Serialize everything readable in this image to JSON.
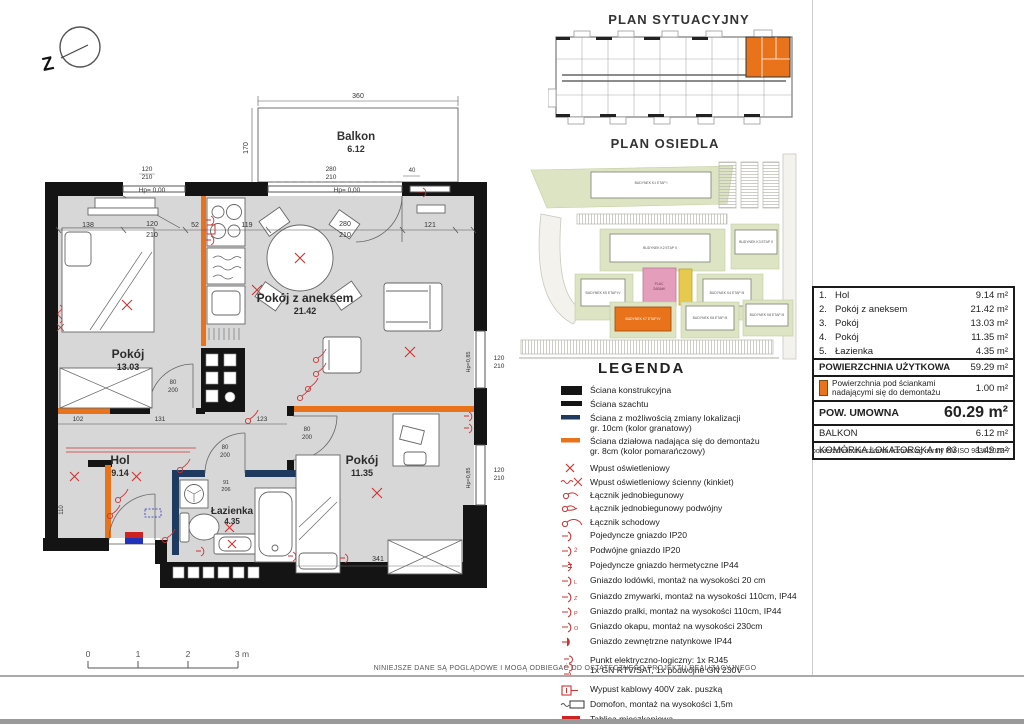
{
  "north_letter": "Z",
  "titles": {
    "situational": "PLAN SYTUACYJNY",
    "estate": "PLAN OSIEDLA",
    "legend": "LEGENDA"
  },
  "plan": {
    "balcony": {
      "name": "Balkon",
      "area": "6.12"
    },
    "rooms": {
      "pokoj1": {
        "name": "Pokój",
        "area": "13.03"
      },
      "aneks": {
        "name": "Pokój z aneksem",
        "area": "21.42"
      },
      "hol": {
        "name": "Hol",
        "area": "9.14"
      },
      "lazienka": {
        "name": "Łazienka",
        "area": "4.35"
      },
      "pokoj2": {
        "name": "Pokój",
        "area": "11.35"
      }
    },
    "dims": {
      "c1": "138",
      "c2": "120",
      "c3": "210",
      "c4": "52",
      "c5": "119",
      "c6": "280",
      "c7": "210",
      "c8": "121",
      "bw": "360",
      "bd": "170",
      "b40": "40",
      "wl1": "120",
      "wl2": "210",
      "wd1": "280",
      "wd2": "210",
      "rw1": "120",
      "rw2": "210",
      "rw3": "120",
      "rw4": "210",
      "hp1": "Hp= 0,00",
      "hp2": "Hp= 0,00",
      "hp3": "Hp=0,85",
      "hp4": "Hp=0,85",
      "h1": "102",
      "h2": "131",
      "h3": "123",
      "d341": "341",
      "d110": "110",
      "dr1a": "80",
      "dr1b": "200",
      "dr2a": "80",
      "dr2b": "200",
      "dr3a": "80",
      "dr3b": "200",
      "bt1": "91",
      "bt2": "206"
    },
    "scale": {
      "s0": "0",
      "s1": "1",
      "s2": "2",
      "s3": "3 m"
    }
  },
  "estate": {
    "b1": "BUDYNEK K1 ETAP I",
    "b2": "BUDYNEK K2 ETAP II",
    "b3": "BUDYNEK K3 ETAP II",
    "b4": "BUDYNEK K5 ETAP IV",
    "b5": "BUDYNEK K4 ETAP III",
    "b6": "BUDYNEK K7 ETAP IV",
    "b7": "BUDYNEK K6 ETAP III",
    "b8": "BUDYNEK K8 ETAP III",
    "plac1": "PLAC",
    "plac2": "ZABAW"
  },
  "legend": {
    "items": [
      {
        "label": "Ściana konstrukcyjna"
      },
      {
        "label": "Ściana szachtu"
      },
      {
        "label": "Ściana z możliwością zmiany lokalizacji\ngr. 10cm (kolor granatowy)"
      },
      {
        "label": "Ściana działowa nadająca się do demontażu\ngr. 8cm (kolor pomarańczowy)"
      },
      {
        "label": "Wpust oświetleniowy"
      },
      {
        "label": "Wpust oświetleniowy ścienny (kinkiet)"
      },
      {
        "label": "Łącznik jednobiegunowy"
      },
      {
        "label": "Łącznik jednobiegunowy podwójny"
      },
      {
        "label": "Łącznik schodowy"
      },
      {
        "label": "Pojedyncze gniazdo IP20"
      },
      {
        "label": "Podwójne gniazdo IP20"
      },
      {
        "label": "Pojedyncze gniazdo hermetyczne IP44"
      },
      {
        "label": "Gniazdo lodówki, montaż na wysokości 20 cm"
      },
      {
        "label": "Gniazdo zmywarki, montaż na wysokości 110cm,  IP44"
      },
      {
        "label": "Gniazdo pralki, montaż na wysokości 110cm, IP44"
      },
      {
        "label": "Gniazdo okapu, montaż na wysokości 230cm"
      },
      {
        "label": "Gniazdo zewnętrzne natynkowe IP44"
      },
      {
        "label": "Punkt elektryczno-logiczny: 1x RJ45\n1x GN RTV/SAT, 1x podwójne GN 230V"
      },
      {
        "label": "Wypust kablowy 400V zak. puszką"
      },
      {
        "label": "Domofon, montaż na wysokości 1,5m"
      },
      {
        "label": "Tablica mieszkaniowa"
      }
    ]
  },
  "table": {
    "rows": [
      {
        "no": "1.",
        "name": "Hol",
        "value": "9.14 m²"
      },
      {
        "no": "2.",
        "name": "Pokój z aneksem",
        "value": "21.42 m²"
      },
      {
        "no": "3.",
        "name": "Pokój",
        "value": "13.03 m²"
      },
      {
        "no": "4.",
        "name": "Pokój",
        "value": "11.35 m²"
      },
      {
        "no": "5.",
        "name": "Łazienka",
        "value": "4.35 m²"
      }
    ],
    "uzytkowa": {
      "label": "POWIERZCHNIA UŻYTKOWA",
      "value": "59.29 m²"
    },
    "note": {
      "label": "Powierzchnia pod ściankami nadającymi się do demontażu",
      "value": "1.00 m²"
    },
    "umowna": {
      "label": "POW. UMOWNA",
      "value": "60.29 m²"
    },
    "balkon": {
      "label": "BALKON",
      "value": "6.12 m²"
    },
    "komorka": {
      "label": "KOMÓRKA LOKATORSKA nr 83",
      "value": "1.49 m²"
    },
    "footnote": "powierzchnia mieszkania liczona wg normy PN-ISO 9836:2022-7"
  },
  "footer": {
    "disclaimer": "NINIEJSZE DANE SĄ POGLĄDOWE I MOGĄ ODBIEGAĆ OD OSTATECZNEGO PROJEKTU REALIZACYJNEGO"
  },
  "colors": {
    "wall": "#141414",
    "navy": "#1e3a5f",
    "orange": "#e8731a",
    "red": "#cc3333",
    "floor": "#d7d7d7",
    "highlight": "#e8731a",
    "pink": "#e49ebc",
    "yellow": "#e6c94d",
    "green": "#dce4c4"
  }
}
